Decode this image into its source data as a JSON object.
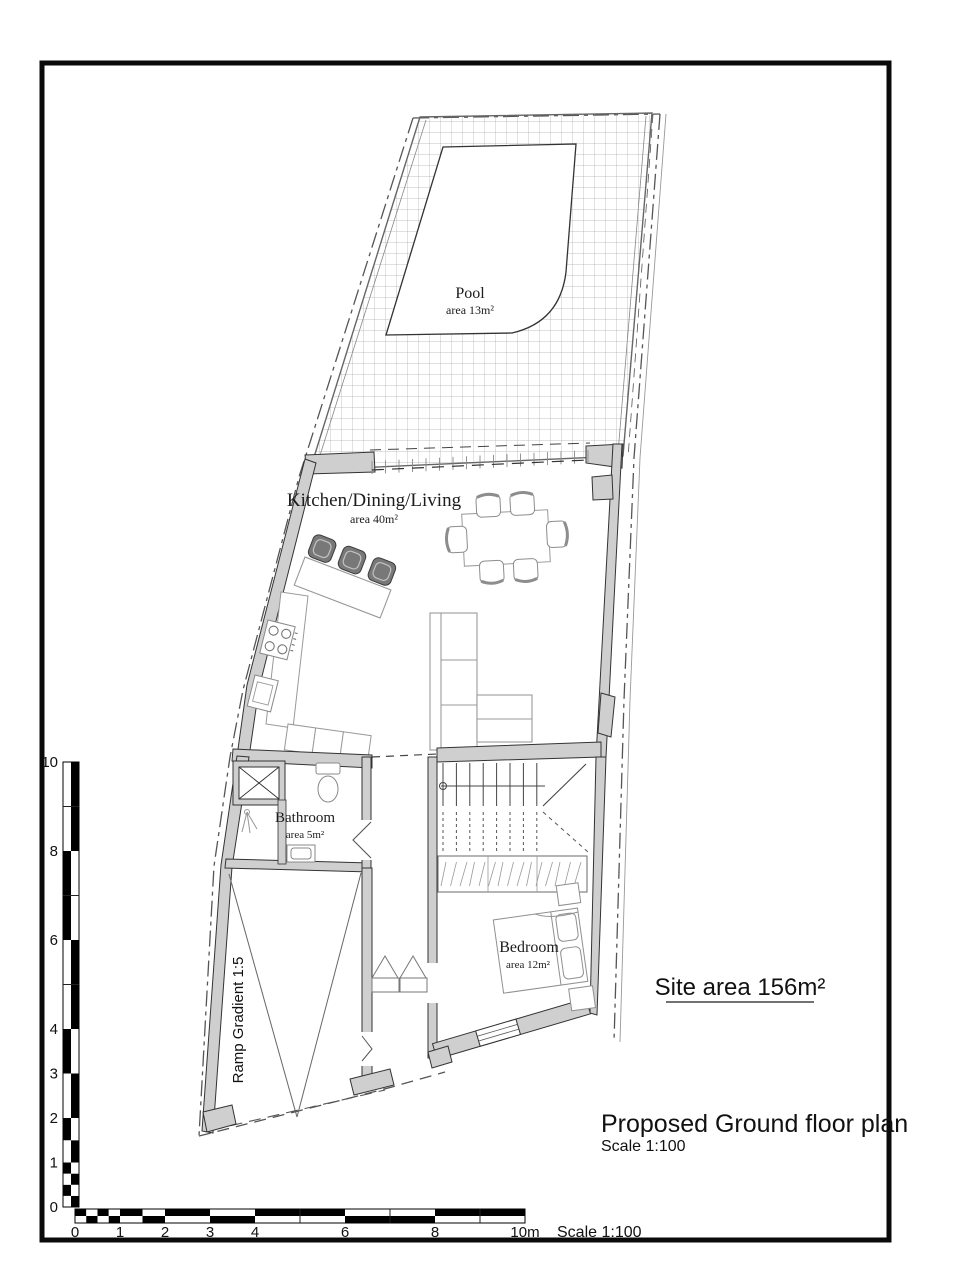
{
  "plan": {
    "rooms": {
      "pool": {
        "name": "Pool",
        "area": "area 13m²"
      },
      "kitchen": {
        "name": "Kitchen/Dining/Living",
        "area": "area 40m²"
      },
      "bathroom": {
        "name": "Bathroom",
        "area": "area 5m²"
      },
      "bedroom": {
        "name": "Bedroom",
        "area": "area 12m²"
      },
      "ramp": {
        "label": "Ramp Gradient 1:5"
      }
    },
    "site_area": "Site area 156m²",
    "title": "Proposed Ground floor plan",
    "title_scale": "Scale 1:100"
  },
  "scalebar": {
    "vertical_labels": [
      "10",
      "8",
      "6",
      "4",
      "3",
      "2",
      "1",
      "0"
    ],
    "vertical_values": [
      10,
      8,
      6,
      4,
      3,
      2,
      1,
      0
    ],
    "horizontal_labels": [
      "0",
      "1",
      "2",
      "3",
      "4",
      "6",
      "8",
      "10m"
    ],
    "horizontal_values": [
      0,
      1,
      2,
      3,
      4,
      6,
      8,
      10
    ],
    "scale_note": "Scale 1:100"
  },
  "colors": {
    "wall_fill": "#cfcfcf",
    "line": "#2f2f2f",
    "furniture_line": "#999999",
    "boundary_line": "#555555",
    "grid_line": "#ababab",
    "frame": "#0a0a0a"
  }
}
